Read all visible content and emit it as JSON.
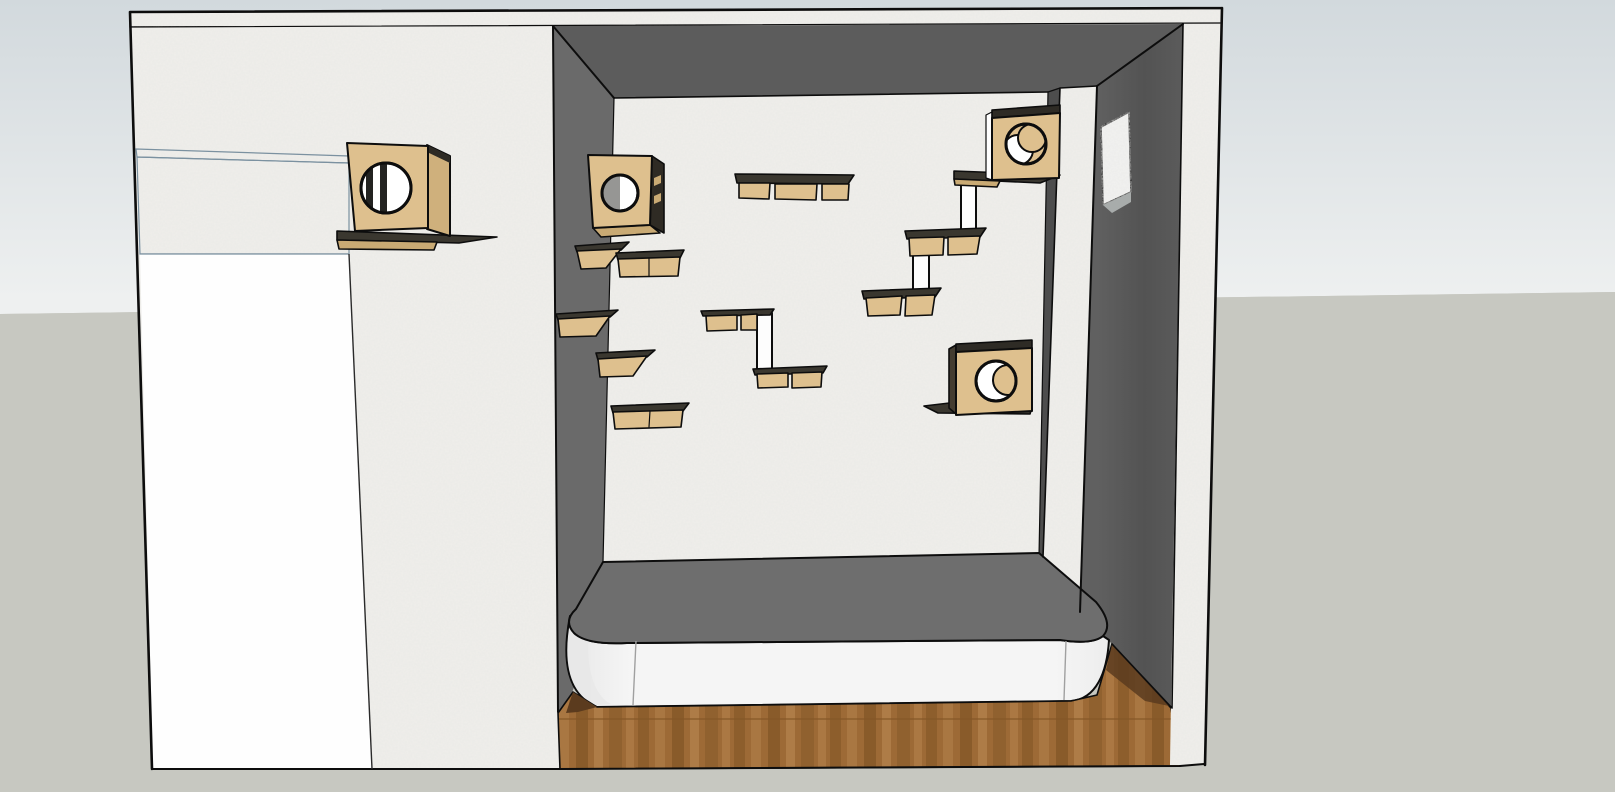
{
  "scene": {
    "title": "Cat room 3D model view",
    "description": "Perspective rendering of a room with wall-mounted cat furniture: four tan cat cubes with round entry holes, stepped wall shelves joined by white posts, a screened window band, a rounded bed platform and a wood plank floor."
  },
  "palette": {
    "outline": "#0d0d0d",
    "sky_top": "#d2d9dd",
    "sky_bottom": "#eef0f0",
    "ground": "#c7c8c1",
    "wall_light": "#efeeea",
    "ceiling": "#5c5c5c",
    "wall_left_int": "#6a6a6a",
    "wall_right_a": "#606060",
    "wall_right_b": "#535353",
    "wall_right_c": "#5b5b5b",
    "wall_strip": "#4d4d4d",
    "sill": "#9dadb8",
    "mesh_bg": "#d8ecf4",
    "mesh_line": "#aed0e2",
    "panel_white": "#fefefe",
    "platform_top": "#6e6e6e",
    "platform_face_l": "#e7e7e7",
    "platform_face_m": "#f5f5f5",
    "platform_face_r": "#ededed",
    "platform_shade": "#e7e7e7",
    "wood_base": "#9d6a36",
    "wood_dark": "#845727",
    "wood_light": "#b5834e",
    "wood_shadow": "#5b3b1e",
    "tan_face": "#dec08e",
    "tan_side": "#cfb07c",
    "tan_edge": "#c9aa74",
    "board_top": "#3a372f",
    "box_top_edge": "#2e2b25",
    "post_white": "#fdfdfd",
    "hole_white": "#ffffff",
    "hole_gray": "#969694",
    "hole_dark": "#232321",
    "opening_white": "#f2f2f0",
    "opening_sill": "#a8acab"
  },
  "objects": [
    {
      "name": "cat-box-1",
      "type": "cat cube with round entry hole",
      "location": "left exterior wall, above shelf"
    },
    {
      "name": "cat-box-2",
      "type": "cat cube with round entry hole",
      "location": "alcove left corner"
    },
    {
      "name": "cat-box-3",
      "type": "cat cube with round entry hole",
      "location": "alcove upper right, on shelf"
    },
    {
      "name": "cat-box-4",
      "type": "cat cube with round entry hole",
      "location": "alcove lower right, on shelf"
    },
    {
      "name": "wall-shelves",
      "type": "stepped cat shelves",
      "count": 12
    },
    {
      "name": "support-posts",
      "type": "white vertical shelf posts",
      "count": 3
    },
    {
      "name": "bed-platform",
      "type": "rounded platform with dark top"
    },
    {
      "name": "wood-floor",
      "type": "brown plank floor"
    },
    {
      "name": "mesh-window",
      "type": "screened window band",
      "location": "upper left wall"
    },
    {
      "name": "wall-opening",
      "type": "pass-through opening",
      "location": "right interior wall"
    }
  ]
}
